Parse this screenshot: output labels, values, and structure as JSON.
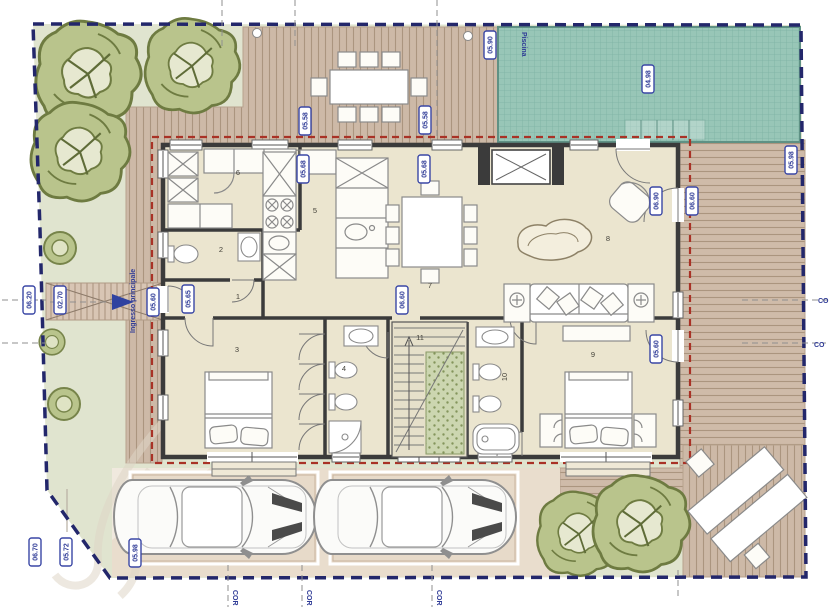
{
  "title": "Site plan with ground floor layout",
  "texts": {
    "piscina": "Piscina",
    "ingresso": "Ingresso principale",
    "cor": "COR",
    "co": "CO"
  },
  "plan": {
    "rooms": {
      "r1": "1",
      "r2": "2",
      "r3": "3",
      "r4": "4",
      "r5": "5",
      "r6": "6",
      "r7": "7",
      "r8": "8",
      "r9": "9",
      "r10": "10",
      "r11": "11"
    },
    "dims": {
      "d1": "05.90",
      "d2": "04.98",
      "d3": "05.58",
      "d4": "05.58",
      "d5": "05.68",
      "d6": "05.68",
      "d7": "05.98",
      "d8": "06.60",
      "d9": "06.90",
      "d10": "06.20",
      "d11": "02.70",
      "d12": "05.60",
      "d13": "05.65",
      "d14": "06.60",
      "d15": "05.60",
      "d16": "06.70",
      "d17": "05.72",
      "d18": "05.98"
    }
  },
  "colors": {
    "boundary": "#23276b",
    "overhang": "#a93226",
    "pool": "#98c6b7",
    "deck": "#cdb9a7",
    "lawn": "#e0e4cf",
    "house_floor": "#ebe5cf",
    "wall": "#3b3b3b",
    "label_blue": "#2e3a96"
  }
}
